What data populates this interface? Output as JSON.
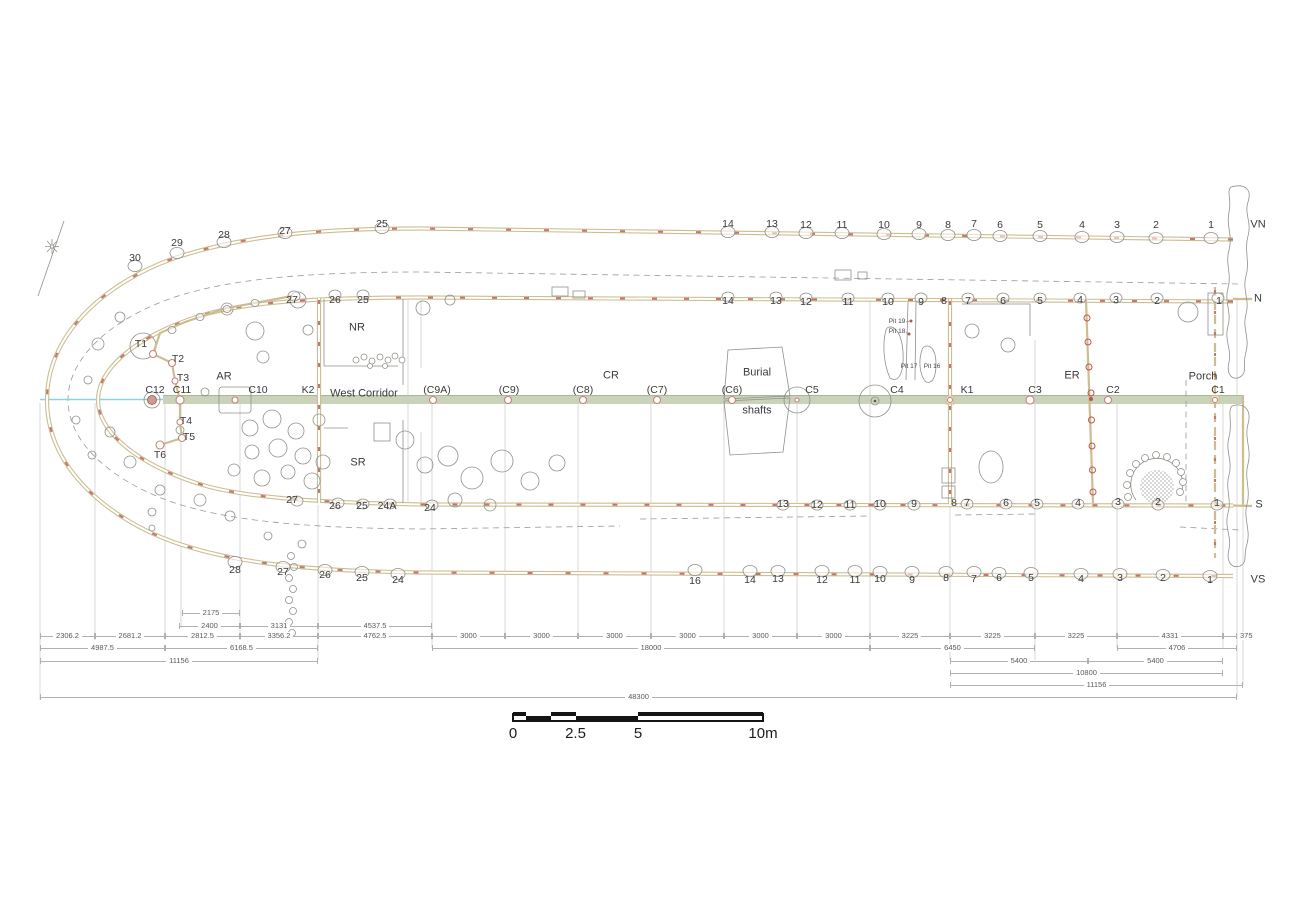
{
  "colors": {
    "wall_tan": "#cdbd92",
    "red_dash": "#c3786f",
    "band_green": "#cad2b9",
    "band_edge": "#aab797",
    "axis_cyan": "#8ed2de",
    "outline_gray": "#90908a",
    "guide_gray": "#c9c9c9",
    "dim_gray": "#5a5a5a",
    "text": "#3a3a3a",
    "scalebar_black": "#141414"
  },
  "labels": {
    "vn-post-number": [
      {
        "t": "30",
        "x": 135,
        "y": 258
      },
      {
        "t": "29",
        "x": 177,
        "y": 243
      },
      {
        "t": "28",
        "x": 224,
        "y": 235
      },
      {
        "t": "27",
        "x": 285,
        "y": 231
      },
      {
        "t": "25",
        "x": 382,
        "y": 224
      },
      {
        "t": "14",
        "x": 728,
        "y": 224
      },
      {
        "t": "13",
        "x": 772,
        "y": 224
      },
      {
        "t": "12",
        "x": 806,
        "y": 225
      },
      {
        "t": "11",
        "x": 842,
        "y": 225
      },
      {
        "t": "10",
        "x": 884,
        "y": 225
      },
      {
        "t": "9",
        "x": 919,
        "y": 225
      },
      {
        "t": "8",
        "x": 948,
        "y": 225
      },
      {
        "t": "7",
        "x": 974,
        "y": 224
      },
      {
        "t": "6",
        "x": 1000,
        "y": 225
      },
      {
        "t": "5",
        "x": 1040,
        "y": 225
      },
      {
        "t": "4",
        "x": 1082,
        "y": 225
      },
      {
        "t": "3",
        "x": 1117,
        "y": 225
      },
      {
        "t": "2",
        "x": 1156,
        "y": 225
      },
      {
        "t": "1",
        "x": 1211,
        "y": 225
      }
    ],
    "n-post-number": [
      {
        "t": "27",
        "x": 292,
        "y": 300
      },
      {
        "t": "26",
        "x": 335,
        "y": 300
      },
      {
        "t": "25",
        "x": 363,
        "y": 300
      },
      {
        "t": "14",
        "x": 728,
        "y": 301
      },
      {
        "t": "13",
        "x": 776,
        "y": 301
      },
      {
        "t": "12",
        "x": 806,
        "y": 302
      },
      {
        "t": "11",
        "x": 848,
        "y": 302
      },
      {
        "t": "10",
        "x": 888,
        "y": 302
      },
      {
        "t": "9",
        "x": 921,
        "y": 302
      },
      {
        "t": "8",
        "x": 944,
        "y": 301
      },
      {
        "t": "7",
        "x": 968,
        "y": 301
      },
      {
        "t": "6",
        "x": 1003,
        "y": 301
      },
      {
        "t": "5",
        "x": 1040,
        "y": 301
      },
      {
        "t": "4",
        "x": 1080,
        "y": 300
      },
      {
        "t": "3",
        "x": 1116,
        "y": 300
      },
      {
        "t": "2",
        "x": 1157,
        "y": 301
      },
      {
        "t": "1",
        "x": 1219,
        "y": 301
      }
    ],
    "s-post-number": [
      {
        "t": "27",
        "x": 292,
        "y": 500
      },
      {
        "t": "26",
        "x": 335,
        "y": 506
      },
      {
        "t": "25",
        "x": 362,
        "y": 506
      },
      {
        "t": "24A",
        "x": 387,
        "y": 506
      },
      {
        "t": "24",
        "x": 430,
        "y": 508
      },
      {
        "t": "13",
        "x": 783,
        "y": 504
      },
      {
        "t": "12",
        "x": 817,
        "y": 505
      },
      {
        "t": "11",
        "x": 850,
        "y": 505
      },
      {
        "t": "10",
        "x": 880,
        "y": 504
      },
      {
        "t": "9",
        "x": 914,
        "y": 504
      },
      {
        "t": "8",
        "x": 954,
        "y": 503
      },
      {
        "t": "7",
        "x": 967,
        "y": 503
      },
      {
        "t": "6",
        "x": 1006,
        "y": 503
      },
      {
        "t": "5",
        "x": 1037,
        "y": 503
      },
      {
        "t": "4",
        "x": 1078,
        "y": 503
      },
      {
        "t": "3",
        "x": 1118,
        "y": 502
      },
      {
        "t": "2",
        "x": 1158,
        "y": 502
      },
      {
        "t": "1",
        "x": 1217,
        "y": 503
      }
    ],
    "vs-post-number": [
      {
        "t": "28",
        "x": 235,
        "y": 570
      },
      {
        "t": "27",
        "x": 283,
        "y": 572
      },
      {
        "t": "26",
        "x": 325,
        "y": 575
      },
      {
        "t": "25",
        "x": 362,
        "y": 578
      },
      {
        "t": "24",
        "x": 398,
        "y": 580
      },
      {
        "t": "16",
        "x": 695,
        "y": 581
      },
      {
        "t": "14",
        "x": 750,
        "y": 580
      },
      {
        "t": "13",
        "x": 778,
        "y": 579
      },
      {
        "t": "12",
        "x": 822,
        "y": 580
      },
      {
        "t": "11",
        "x": 855,
        "y": 580
      },
      {
        "t": "10",
        "x": 880,
        "y": 579
      },
      {
        "t": "9",
        "x": 912,
        "y": 580
      },
      {
        "t": "8",
        "x": 946,
        "y": 578
      },
      {
        "t": "7",
        "x": 974,
        "y": 579
      },
      {
        "t": "6",
        "x": 999,
        "y": 578
      },
      {
        "t": "5",
        "x": 1031,
        "y": 578
      },
      {
        "t": "4",
        "x": 1081,
        "y": 579
      },
      {
        "t": "3",
        "x": 1120,
        "y": 578
      },
      {
        "t": "2",
        "x": 1163,
        "y": 578
      },
      {
        "t": "1",
        "x": 1210,
        "y": 580
      }
    ],
    "row-letter": [
      {
        "t": "VN",
        "x": 1258,
        "y": 225,
        "c": "letter"
      },
      {
        "t": "N",
        "x": 1258,
        "y": 299,
        "c": "letter"
      },
      {
        "t": "S",
        "x": 1259,
        "y": 505,
        "c": "letter"
      },
      {
        "t": "VS",
        "x": 1258,
        "y": 580,
        "c": "letter"
      }
    ],
    "area": [
      {
        "t": "NR",
        "x": 357,
        "y": 328,
        "c": "area"
      },
      {
        "t": "SR",
        "x": 358,
        "y": 463,
        "c": "area"
      },
      {
        "t": "AR",
        "x": 224,
        "y": 377,
        "c": "area"
      },
      {
        "t": "CR",
        "x": 611,
        "y": 376,
        "c": "area"
      },
      {
        "t": "ER",
        "x": 1072,
        "y": 376,
        "c": "area"
      },
      {
        "t": "Porch",
        "x": 1203,
        "y": 377,
        "c": "area"
      },
      {
        "t": "West Corridor",
        "x": 364,
        "y": 394,
        "c": "area"
      },
      {
        "t": "Burial",
        "x": 757,
        "y": 373,
        "c": "area"
      },
      {
        "t": "shafts",
        "x": 757,
        "y": 411,
        "c": "area"
      }
    ],
    "column": [
      {
        "t": "C12",
        "x": 155,
        "y": 390
      },
      {
        "t": "C11",
        "x": 182,
        "y": 390
      },
      {
        "t": "C10",
        "x": 258,
        "y": 390
      },
      {
        "t": "K2",
        "x": 308,
        "y": 390
      },
      {
        "t": "(C9A)",
        "x": 437,
        "y": 390
      },
      {
        "t": "(C9)",
        "x": 509,
        "y": 390
      },
      {
        "t": "(C8)",
        "x": 583,
        "y": 390
      },
      {
        "t": "(C7)",
        "x": 657,
        "y": 390
      },
      {
        "t": "(C6)",
        "x": 732,
        "y": 390
      },
      {
        "t": "C5",
        "x": 812,
        "y": 390
      },
      {
        "t": "C4",
        "x": 897,
        "y": 390
      },
      {
        "t": "K1",
        "x": 967,
        "y": 390
      },
      {
        "t": "C3",
        "x": 1035,
        "y": 390
      },
      {
        "t": "C2",
        "x": 1113,
        "y": 390
      },
      {
        "t": "C1",
        "x": 1218,
        "y": 390
      }
    ],
    "t-post": [
      {
        "t": "T1",
        "x": 141,
        "y": 344
      },
      {
        "t": "T2",
        "x": 178,
        "y": 359
      },
      {
        "t": "T3",
        "x": 183,
        "y": 378
      },
      {
        "t": "T4",
        "x": 186,
        "y": 421
      },
      {
        "t": "T5",
        "x": 189,
        "y": 437
      },
      {
        "t": "T6",
        "x": 160,
        "y": 455
      }
    ],
    "pit": [
      {
        "t": "Pit 19",
        "x": 897,
        "y": 322,
        "c": "pit"
      },
      {
        "t": "Pit 18",
        "x": 897,
        "y": 332,
        "c": "pit"
      },
      {
        "t": "Pit 17",
        "x": 909,
        "y": 367,
        "c": "pit"
      },
      {
        "t": "Pit 16",
        "x": 932,
        "y": 367,
        "c": "pit"
      }
    ]
  },
  "dimensions": [
    {
      "y": 613,
      "segments": [
        {
          "x1": 182,
          "x2": 240,
          "t": "2175"
        }
      ]
    },
    {
      "y": 626,
      "segments": [
        {
          "x1": 179,
          "x2": 240,
          "t": "2400"
        },
        {
          "x1": 240,
          "x2": 318,
          "t": "3131"
        },
        {
          "x1": 318,
          "x2": 432,
          "t": "4537.5"
        }
      ]
    },
    {
      "y": 636,
      "segments": [
        {
          "x1": 40,
          "x2": 95,
          "t": "2306.2"
        },
        {
          "x1": 95,
          "x2": 165,
          "t": "2681.2"
        },
        {
          "x1": 165,
          "x2": 240,
          "t": "2812.5"
        },
        {
          "x1": 240,
          "x2": 318,
          "t": "3356.2"
        },
        {
          "x1": 318,
          "x2": 432,
          "t": "4762.5"
        },
        {
          "x1": 432,
          "x2": 505,
          "t": "3000"
        },
        {
          "x1": 505,
          "x2": 578,
          "t": "3000"
        },
        {
          "x1": 578,
          "x2": 651,
          "t": "3000"
        },
        {
          "x1": 651,
          "x2": 724,
          "t": "3000"
        },
        {
          "x1": 724,
          "x2": 797,
          "t": "3000"
        },
        {
          "x1": 797,
          "x2": 870,
          "t": "3000"
        },
        {
          "x1": 870,
          "x2": 950,
          "t": "3225"
        },
        {
          "x1": 950,
          "x2": 1035,
          "t": "3225"
        },
        {
          "x1": 1035,
          "x2": 1117,
          "t": "3225"
        },
        {
          "x1": 1117,
          "x2": 1223,
          "t": "4331"
        },
        {
          "x1": 1223,
          "x2": 1237,
          "t": "375",
          "o": 1
        }
      ]
    },
    {
      "y": 648,
      "segments": [
        {
          "x1": 40,
          "x2": 165,
          "t": "4987.5"
        },
        {
          "x1": 165,
          "x2": 318,
          "t": "6168.5"
        },
        {
          "x1": 432,
          "x2": 870,
          "t": "18000"
        },
        {
          "x1": 870,
          "x2": 1035,
          "t": "6450"
        },
        {
          "x1": 1117,
          "x2": 1237,
          "t": "4706"
        }
      ]
    },
    {
      "y": 661,
      "segments": [
        {
          "x1": 40,
          "x2": 318,
          "t": "11156"
        },
        {
          "x1": 950,
          "x2": 1088,
          "t": "5400"
        },
        {
          "x1": 1088,
          "x2": 1223,
          "t": "5400"
        }
      ]
    },
    {
      "y": 673,
      "segments": [
        {
          "x1": 950,
          "x2": 1223,
          "t": "10800"
        }
      ]
    },
    {
      "y": 685,
      "segments": [
        {
          "x1": 950,
          "x2": 1243,
          "t": "11156"
        }
      ]
    },
    {
      "y": 697,
      "segments": [
        {
          "x1": 40,
          "x2": 1237,
          "t": "48300"
        }
      ]
    }
  ],
  "scalebar": {
    "x": 513,
    "y": 712,
    "width": 250,
    "blocks": [
      {
        "x1": 0,
        "x2": 12.5,
        "row": 0
      },
      {
        "x1": 12.5,
        "x2": 37.5,
        "row": 1
      },
      {
        "x1": 37.5,
        "x2": 62.5,
        "row": 0
      },
      {
        "x1": 62.5,
        "x2": 125,
        "row": 1
      },
      {
        "x1": 125,
        "x2": 250,
        "row": 0
      }
    ],
    "labels": [
      {
        "t": "0",
        "x": 0
      },
      {
        "t": "2.5",
        "x": 62.5
      },
      {
        "t": "5",
        "x": 125
      },
      {
        "t": "10m",
        "x": 250
      }
    ]
  }
}
